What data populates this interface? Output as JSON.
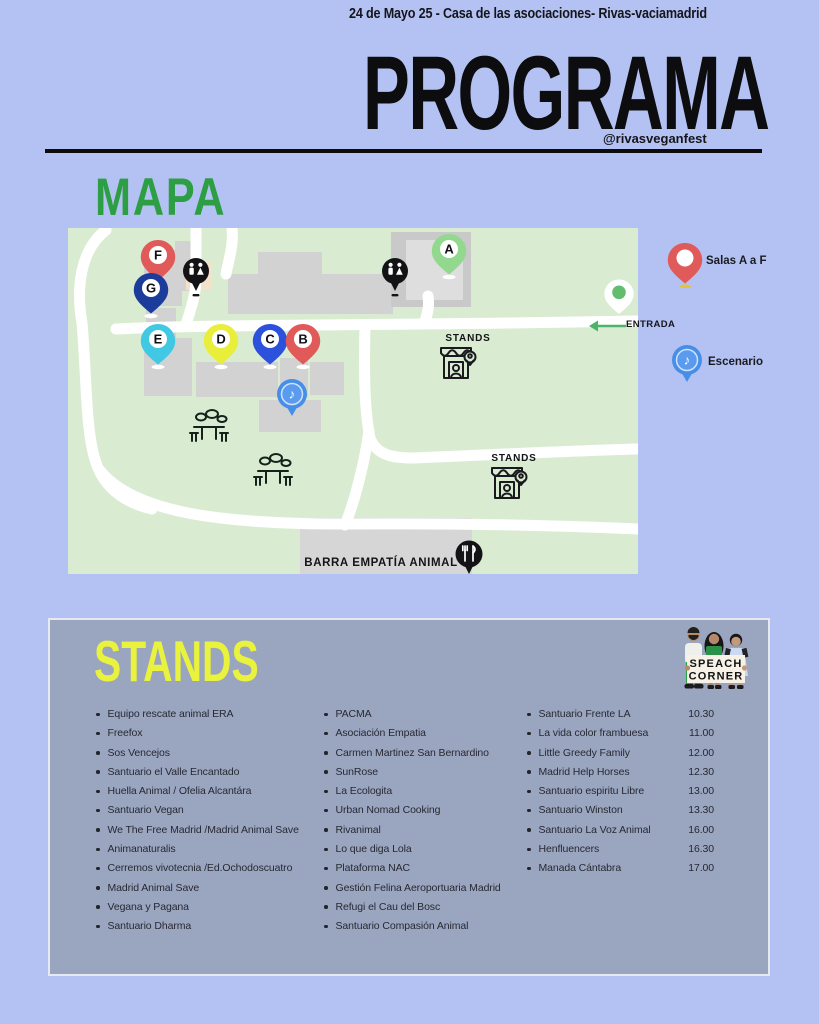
{
  "header": {
    "date_line": "24 de Mayo 25 - Casa de las asociaciones-  Rivas-vaciamadrid",
    "title": "PROGRAMA",
    "handle": "@rivasveganfest"
  },
  "map": {
    "heading": "MAPA",
    "stands_label": "STANDS",
    "bar_label": "BARRA EMPATÍA ANIMAL",
    "entrance_label": "ENTRADA",
    "pin_labels": [
      "A",
      "B",
      "C",
      "D",
      "E",
      "F",
      "G"
    ],
    "legend": {
      "rooms_label": "Salas A a F",
      "stage_label": "Escenario"
    },
    "colors": {
      "map_bg": "#d9ecd2",
      "pin_red": "#e05a5a",
      "pin_navy": "#1c3c9c",
      "pin_cyan": "#41c8e3",
      "pin_yellow": "#e9ee3a",
      "pin_blue": "#2b51dd",
      "pin_green": "#92d88e",
      "entrance_green": "#63bd6e",
      "stage_blue": "#478fe6"
    }
  },
  "stands": {
    "heading": "STANDS",
    "sign_line1": "SPEACH",
    "sign_line2": "CORNER",
    "col1": [
      "Equipo rescate animal ERA",
      "Freefox",
      "Sos Vencejos",
      "Santuario el Valle Encantado",
      "Huella Animal / Ofelia Alcantára",
      "Santuario Vegan",
      "We The Free Madrid /Madrid Animal Save",
      "Animanaturalis",
      "Cerremos vivotecnia /Ed.Ochodoscuatro",
      "Madrid Animal Save",
      "Vegana y Pagana",
      "Santuario Dharma"
    ],
    "col2": [
      "PACMA",
      "Asociación Empatia",
      "Carmen Martinez San Bernardino",
      "SunRose",
      "La Ecologita",
      "Urban Nomad Cooking",
      "Rivanimal",
      "Lo que diga Lola",
      "Plataforma NAC",
      "Gestión Felina Aeroportuaria Madrid",
      "Refugi el Cau del Bosc",
      "Santuario Compasión Animal"
    ],
    "col3": [
      {
        "name": "Santuario Frente LA",
        "time": "10.30"
      },
      {
        "name": "La vida color frambuesa",
        "time": "11.00"
      },
      {
        "name": "Little Greedy Family",
        "time": "12.00"
      },
      {
        "name": "Madrid Help Horses",
        "time": "12.30"
      },
      {
        "name": "Santuario espiritu Libre",
        "time": "13.00"
      },
      {
        "name": "Santuario Winston",
        "time": "13.30"
      },
      {
        "name": "Santuario La Voz Animal",
        "time": "16.00"
      },
      {
        "name": "Henfluencers",
        "time": "16.30"
      },
      {
        "name": "Manada Cántabra",
        "time": "17.00"
      }
    ]
  }
}
